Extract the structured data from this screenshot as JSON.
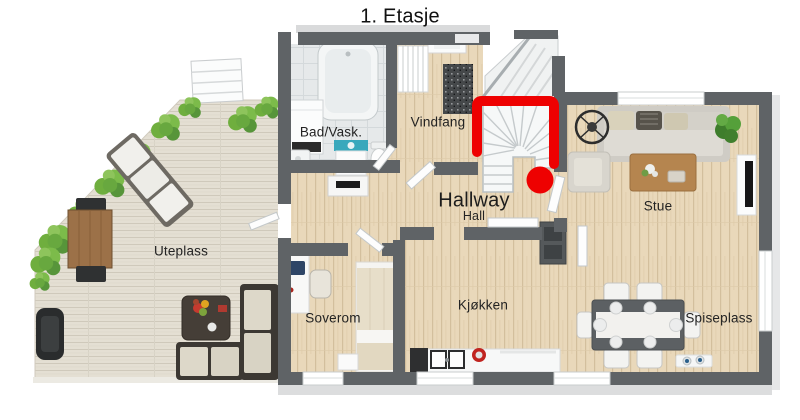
{
  "title": "1. Etasje",
  "rooms": {
    "uteplass": {
      "label": "Uteplass"
    },
    "bad_vask": {
      "label": "Bad/Vask."
    },
    "vindfang": {
      "label": "Vindfang"
    },
    "hallway": {
      "label": "Hallway"
    },
    "hall": {
      "label": "Hall"
    },
    "stue": {
      "label": "Stue"
    },
    "soverom": {
      "label": "Soverom"
    },
    "kjokken": {
      "label": "Kjøkken"
    },
    "spiseplass": {
      "label": "Spiseplass"
    }
  },
  "annotation": {
    "type": "highlight-bracket-and-dot",
    "target": "staircase",
    "color": "#ee0101"
  },
  "colors": {
    "wall_gray": "#5f6366",
    "wood_floor": "#e9d8ba",
    "terrace_deck": "#e4dfd3",
    "bathroom_tile": "#e6e9ea",
    "plant_green": "#72b043"
  }
}
